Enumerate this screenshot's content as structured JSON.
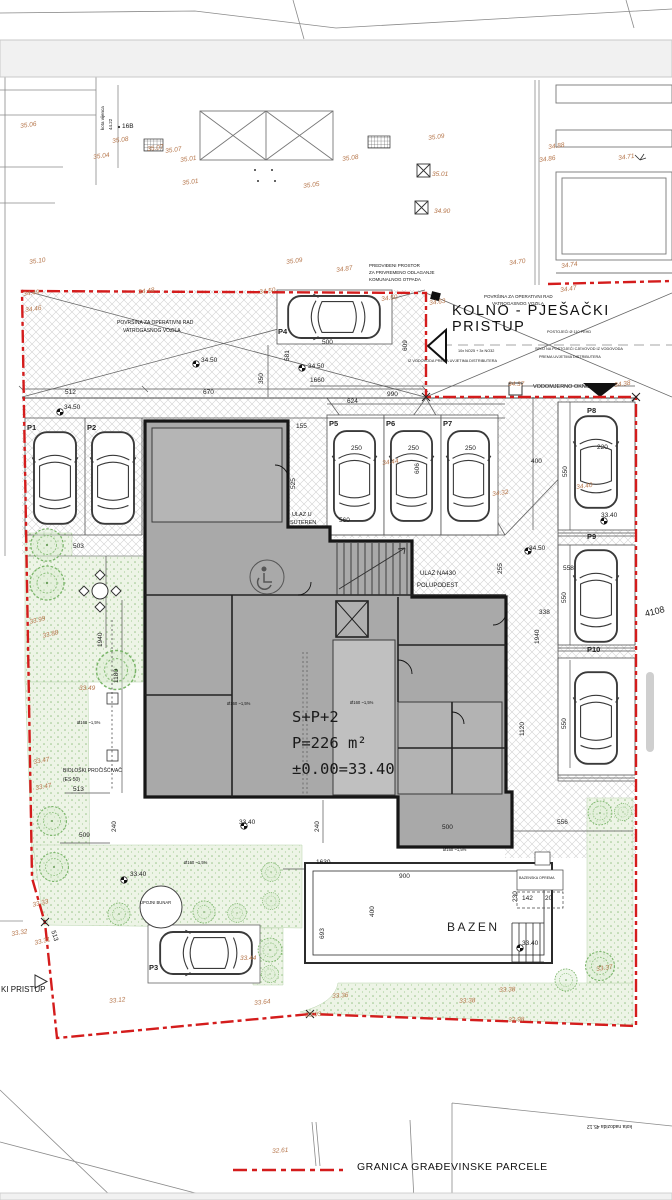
{
  "colors": {
    "boundary_red": "#d41c1c",
    "elevation_text": "#b5754a",
    "building_fill": "#a9a9a9",
    "green_stroke": "#7ab569",
    "hatch": "#cfcfcf"
  },
  "plan": {
    "access_title": "KOLNO - PJEŠAČKI PRISTUP",
    "pool_label": "BAZEN",
    "building": {
      "storeys": "S+P+2",
      "area": "P=226 m²",
      "datum": "±0.00=33.40"
    },
    "legend": {
      "boundary": "GRANICA GRAĐEVINSKE PARCELE"
    }
  },
  "annotations": {
    "elevations": [
      {
        "x": 20,
        "y": 124,
        "t": "35.06"
      },
      {
        "x": 93,
        "y": 155,
        "t": "35.04"
      },
      {
        "x": 112,
        "y": 139,
        "t": "35.08"
      },
      {
        "x": 147,
        "y": 147,
        "t": "35.07"
      },
      {
        "x": 165,
        "y": 149,
        "t": "35.07"
      },
      {
        "x": 180,
        "y": 158,
        "t": "35.01"
      },
      {
        "x": 182,
        "y": 181,
        "t": "35.01"
      },
      {
        "x": 303,
        "y": 184,
        "t": "35.05"
      },
      {
        "x": 29,
        "y": 260,
        "t": "35.10"
      },
      {
        "x": 286,
        "y": 260,
        "t": "35.09"
      },
      {
        "x": 428,
        "y": 136,
        "t": "35.09"
      },
      {
        "x": 342,
        "y": 157,
        "t": "35.08"
      },
      {
        "x": 432,
        "y": 172,
        "t": "35.01",
        "r": 0
      },
      {
        "x": 434,
        "y": 209,
        "t": "34.90",
        "r": 0
      },
      {
        "x": 548,
        "y": 145,
        "t": "34.88"
      },
      {
        "x": 539,
        "y": 158,
        "t": "34.86"
      },
      {
        "x": 618,
        "y": 156,
        "t": "34.71"
      },
      {
        "x": 509,
        "y": 261,
        "t": "34.70"
      },
      {
        "x": 561,
        "y": 264,
        "t": "34.74"
      },
      {
        "x": 336,
        "y": 268,
        "t": "34.87"
      },
      {
        "x": 560,
        "y": 288,
        "t": "34.47"
      },
      {
        "x": 23,
        "y": 292,
        "t": "34.49"
      },
      {
        "x": 25,
        "y": 308,
        "t": "34.46"
      },
      {
        "x": 138,
        "y": 290,
        "t": "34.48"
      },
      {
        "x": 259,
        "y": 290,
        "t": "34.50"
      },
      {
        "x": 381,
        "y": 297,
        "t": "34.50"
      },
      {
        "x": 429,
        "y": 301,
        "t": "34.63"
      },
      {
        "x": 508,
        "y": 382,
        "t": "34.37",
        "r": 0
      },
      {
        "x": 614,
        "y": 383,
        "t": "34.38"
      },
      {
        "x": 382,
        "y": 461,
        "t": "34.44"
      },
      {
        "x": 492,
        "y": 492,
        "t": "34.32"
      },
      {
        "x": 576,
        "y": 485,
        "t": "34.40"
      },
      {
        "x": 29,
        "y": 620,
        "t": "33.99",
        "r": -14
      },
      {
        "x": 42,
        "y": 634,
        "t": "33.88",
        "r": -14
      },
      {
        "x": 79,
        "y": 686,
        "t": "33.49",
        "r": 0
      },
      {
        "x": 33,
        "y": 760,
        "t": "33.47",
        "r": -10
      },
      {
        "x": 35,
        "y": 786,
        "t": "33.47",
        "r": -10
      },
      {
        "x": 32,
        "y": 903,
        "t": "33.33",
        "r": -14
      },
      {
        "x": 11,
        "y": 932,
        "t": "33.32",
        "r": -10
      },
      {
        "x": 34,
        "y": 941,
        "t": "33.31",
        "r": -14
      },
      {
        "x": 109,
        "y": 999,
        "t": "33.12",
        "r": -6
      },
      {
        "x": 305,
        "y": 1013,
        "t": "33.03",
        "r": -4
      },
      {
        "x": 332,
        "y": 994,
        "t": "33.36",
        "r": -4
      },
      {
        "x": 459,
        "y": 999,
        "t": "33.38",
        "r": -3
      },
      {
        "x": 499,
        "y": 988,
        "t": "33.38",
        "r": -3
      },
      {
        "x": 508,
        "y": 1018,
        "t": "32.98",
        "r": -3
      },
      {
        "x": 254,
        "y": 1001,
        "t": "33.64",
        "r": -6
      },
      {
        "x": 240,
        "y": 956,
        "t": "33.44",
        "r": 0
      },
      {
        "x": 596,
        "y": 967,
        "t": "33.37",
        "r": -8
      },
      {
        "x": 272,
        "y": 1149,
        "t": "32.61",
        "r": -4
      }
    ],
    "dimensions": [
      {
        "x": 65,
        "y": 390,
        "t": "512"
      },
      {
        "x": 203,
        "y": 390,
        "t": "670"
      },
      {
        "x": 259,
        "y": 384,
        "t": "350",
        "v": 1
      },
      {
        "x": 310,
        "y": 378,
        "t": "1660"
      },
      {
        "x": 347,
        "y": 399,
        "t": "624"
      },
      {
        "x": 387,
        "y": 392,
        "t": "990"
      },
      {
        "x": 403,
        "y": 351,
        "t": "609",
        "v": 1
      },
      {
        "x": 296,
        "y": 424,
        "t": "155"
      },
      {
        "x": 291,
        "y": 489,
        "t": "525",
        "v": 1
      },
      {
        "x": 285,
        "y": 361,
        "t": "581",
        "v": 1
      },
      {
        "x": 322,
        "y": 340,
        "t": "500"
      },
      {
        "x": 339,
        "y": 518,
        "t": "560"
      },
      {
        "x": 351,
        "y": 446,
        "t": "250"
      },
      {
        "x": 408,
        "y": 446,
        "t": "250"
      },
      {
        "x": 465,
        "y": 446,
        "t": "250"
      },
      {
        "x": 415,
        "y": 474,
        "t": "606",
        "v": 1
      },
      {
        "x": 531,
        "y": 459,
        "t": "400"
      },
      {
        "x": 563,
        "y": 477,
        "t": "550",
        "v": 1
      },
      {
        "x": 597,
        "y": 445,
        "t": "220"
      },
      {
        "x": 498,
        "y": 574,
        "t": "255",
        "v": 1
      },
      {
        "x": 445,
        "y": 571,
        "t": "430"
      },
      {
        "x": 563,
        "y": 566,
        "t": "558"
      },
      {
        "x": 562,
        "y": 603,
        "t": "550",
        "v": 1
      },
      {
        "x": 539,
        "y": 610,
        "t": "338"
      },
      {
        "x": 535,
        "y": 644,
        "t": "1940",
        "v": 1
      },
      {
        "x": 520,
        "y": 736,
        "t": "1120",
        "v": 1
      },
      {
        "x": 562,
        "y": 729,
        "t": "550",
        "v": 1
      },
      {
        "x": 98,
        "y": 647,
        "t": "1940",
        "v": 1
      },
      {
        "x": 114,
        "y": 683,
        "t": "1180",
        "v": 1
      },
      {
        "x": 112,
        "y": 832,
        "t": "240",
        "v": 1
      },
      {
        "x": 73,
        "y": 787,
        "t": "513"
      },
      {
        "x": 79,
        "y": 833,
        "t": "509"
      },
      {
        "x": 55,
        "y": 930,
        "t": "513",
        "r": 72
      },
      {
        "x": 315,
        "y": 832,
        "t": "240",
        "v": 1
      },
      {
        "x": 442,
        "y": 825,
        "t": "500"
      },
      {
        "x": 557,
        "y": 820,
        "t": "556"
      },
      {
        "x": 316,
        "y": 860,
        "t": "1630"
      },
      {
        "x": 399,
        "y": 874,
        "t": "900"
      },
      {
        "x": 370,
        "y": 917,
        "t": "400",
        "v": 1
      },
      {
        "x": 320,
        "y": 939,
        "t": "693",
        "v": 1
      },
      {
        "x": 513,
        "y": 902,
        "t": "230",
        "v": 1
      },
      {
        "x": 522,
        "y": 896,
        "t": "142"
      },
      {
        "x": 545,
        "y": 896,
        "t": "20"
      },
      {
        "x": 73,
        "y": 544,
        "t": "503"
      },
      {
        "x": 64,
        "y": 405,
        "t": "34.50"
      },
      {
        "x": 201,
        "y": 358,
        "t": "34.50"
      },
      {
        "x": 308,
        "y": 364,
        "t": "34.50"
      },
      {
        "x": 529,
        "y": 546,
        "t": "34.50"
      },
      {
        "x": 601,
        "y": 513,
        "t": "33.40"
      },
      {
        "x": 239,
        "y": 820,
        "t": "33.40"
      },
      {
        "x": 130,
        "y": 872,
        "t": "33.40"
      },
      {
        "x": 522,
        "y": 941,
        "t": "33.40"
      },
      {
        "x": 644,
        "y": 610,
        "t": "4108",
        "r": -14,
        "s": 9
      }
    ],
    "notes": [
      {
        "x": 117,
        "y": 321,
        "t": "POVRŠINA ZA OPERATIVNI RAD",
        "s": 5
      },
      {
        "x": 123,
        "y": 329,
        "t": "VATROGASNOG VOZILA",
        "s": 5
      },
      {
        "x": 484,
        "y": 295,
        "t": "POVRŠINA ZA OPERATIVNI RAD",
        "s": 4.5
      },
      {
        "x": 492,
        "y": 302,
        "t": "VATROGASNOG VOZILA",
        "s": 4.5
      },
      {
        "x": 369,
        "y": 264,
        "t": "PREDVIĐENI PROSTOR",
        "s": 4.5
      },
      {
        "x": 369,
        "y": 271,
        "t": "ZA PRIVREMENO ODLAGANJE",
        "s": 4.5
      },
      {
        "x": 369,
        "y": 278,
        "t": "KOMUNALNOG OTPADA",
        "s": 4.5
      },
      {
        "x": 547,
        "y": 331,
        "t": "POSTOJEĆI Ø 110 PEHD",
        "s": 3.8
      },
      {
        "x": 535,
        "y": 348,
        "t": "SPOJ NA POSTOJEĆI CJEVOVOD IZ VODOVODA",
        "s": 3.8
      },
      {
        "x": 539,
        "y": 356,
        "t": "PREMA UVJETIMA DISTRIBUTERA",
        "s": 3.8
      },
      {
        "x": 458,
        "y": 350,
        "t": "10x NO25 + 3x NO32",
        "s": 3.8
      },
      {
        "x": 408,
        "y": 360,
        "t": "IZ VODOVODA PREMA UVJETIMA DISTRIBUTERA",
        "s": 3.8
      },
      {
        "x": 533,
        "y": 385,
        "t": "VODOMJERNO OKNO",
        "s": 5.5
      },
      {
        "x": 292,
        "y": 513,
        "t": "ULAZ U",
        "s": 5.5
      },
      {
        "x": 290,
        "y": 521,
        "t": "SUTEREN",
        "s": 5.5
      },
      {
        "x": 420,
        "y": 571,
        "t": "ULAZ NA",
        "s": 6
      },
      {
        "x": 417,
        "y": 583,
        "t": "POLUPODEST",
        "s": 6
      },
      {
        "x": 63,
        "y": 769,
        "t": "BIOLOŠKI PROČIŠĆIVAČ",
        "s": 5
      },
      {
        "x": 63,
        "y": 778,
        "t": "(ES 50)",
        "s": 5
      },
      {
        "x": 140,
        "y": 901,
        "t": "UPOJNI BUNAR",
        "s": 4.2
      },
      {
        "x": 519,
        "y": 877,
        "t": "BAZENSKA OPREMA",
        "s": 3.6
      },
      {
        "x": 1,
        "y": 986,
        "t": "KI PRISTUP",
        "s": 8
      },
      {
        "x": 122,
        "y": 124,
        "t": "16B",
        "s": 6.5
      },
      {
        "x": 101,
        "y": 130,
        "t": "kota vijenca",
        "s": 4.5,
        "r": -90
      },
      {
        "x": 109,
        "y": 130,
        "t": "44.22",
        "s": 4.5,
        "r": -90
      },
      {
        "x": 632,
        "y": 1128,
        "t": "kota nadozida  45.12",
        "s": 5,
        "r": 180
      },
      {
        "x": 227,
        "y": 702,
        "t": "Ø160 ~1,5%",
        "s": 4.2
      },
      {
        "x": 350,
        "y": 701,
        "t": "Ø160 ~1,5%",
        "s": 4.2
      },
      {
        "x": 77,
        "y": 721,
        "t": "Ø160 ~1,5%",
        "s": 4.2
      },
      {
        "x": 443,
        "y": 848,
        "t": "Ø160 ~1,5%",
        "s": 4.2
      },
      {
        "x": 184,
        "y": 861,
        "t": "Ø160 ~1,5%",
        "s": 4.2
      }
    ],
    "parking_ids": [
      {
        "x": 27,
        "y": 424,
        "t": "P1"
      },
      {
        "x": 87,
        "y": 424,
        "t": "P2"
      },
      {
        "x": 149,
        "y": 964,
        "t": "P3"
      },
      {
        "x": 278,
        "y": 328,
        "t": "P4"
      },
      {
        "x": 329,
        "y": 420,
        "t": "P5"
      },
      {
        "x": 386,
        "y": 420,
        "t": "P6"
      },
      {
        "x": 443,
        "y": 420,
        "t": "P7"
      },
      {
        "x": 587,
        "y": 407,
        "t": "P8"
      },
      {
        "x": 587,
        "y": 533,
        "t": "P9"
      },
      {
        "x": 587,
        "y": 646,
        "t": "P10"
      }
    ]
  },
  "objects": {
    "cars": [
      {
        "x": 31,
        "y": 428,
        "w": 48,
        "h": 100,
        "r": 0
      },
      {
        "x": 89,
        "y": 428,
        "w": 48,
        "h": 100,
        "r": 0
      },
      {
        "x": 331,
        "y": 424,
        "w": 47,
        "h": 104,
        "r": 0
      },
      {
        "x": 388,
        "y": 424,
        "w": 47,
        "h": 104,
        "r": 0
      },
      {
        "x": 445,
        "y": 424,
        "w": 47,
        "h": 104,
        "r": 0
      },
      {
        "x": 572,
        "y": 410,
        "w": 48,
        "h": 104,
        "r": 0
      },
      {
        "x": 572,
        "y": 546,
        "w": 48,
        "h": 100,
        "r": 0
      },
      {
        "x": 572,
        "y": 668,
        "w": 48,
        "h": 100,
        "r": 0
      },
      {
        "x": 310,
        "y": 266,
        "w": 48,
        "h": 102,
        "r": -90
      },
      {
        "x": 182,
        "y": 902,
        "w": 48,
        "h": 102,
        "r": -90
      }
    ],
    "trees": [
      {
        "x": 47,
        "y": 545,
        "rad": 19
      },
      {
        "x": 47,
        "y": 583,
        "rad": 20
      },
      {
        "x": 116,
        "y": 670,
        "rad": 23
      },
      {
        "x": 52,
        "y": 821,
        "rad": 17
      },
      {
        "x": 54,
        "y": 867,
        "rad": 17
      },
      {
        "x": 119,
        "y": 914,
        "rad": 13
      },
      {
        "x": 160,
        "y": 911,
        "rad": 17
      },
      {
        "x": 204,
        "y": 912,
        "rad": 13
      },
      {
        "x": 237,
        "y": 913,
        "rad": 11
      },
      {
        "x": 271,
        "y": 872,
        "rad": 11
      },
      {
        "x": 271,
        "y": 901,
        "rad": 10
      },
      {
        "x": 270,
        "y": 950,
        "rad": 14
      },
      {
        "x": 270,
        "y": 974,
        "rad": 10
      },
      {
        "x": 600,
        "y": 813,
        "rad": 14
      },
      {
        "x": 623,
        "y": 812,
        "rad": 10
      },
      {
        "x": 566,
        "y": 980,
        "rad": 13
      },
      {
        "x": 600,
        "y": 966,
        "rad": 17
      }
    ],
    "benchmarks": [
      {
        "x": 60,
        "y": 412
      },
      {
        "x": 196,
        "y": 364
      },
      {
        "x": 302,
        "y": 368
      },
      {
        "x": 528,
        "y": 551
      },
      {
        "x": 124,
        "y": 880
      },
      {
        "x": 244,
        "y": 826
      },
      {
        "x": 520,
        "y": 948
      },
      {
        "x": 604,
        "y": 521
      }
    ]
  }
}
